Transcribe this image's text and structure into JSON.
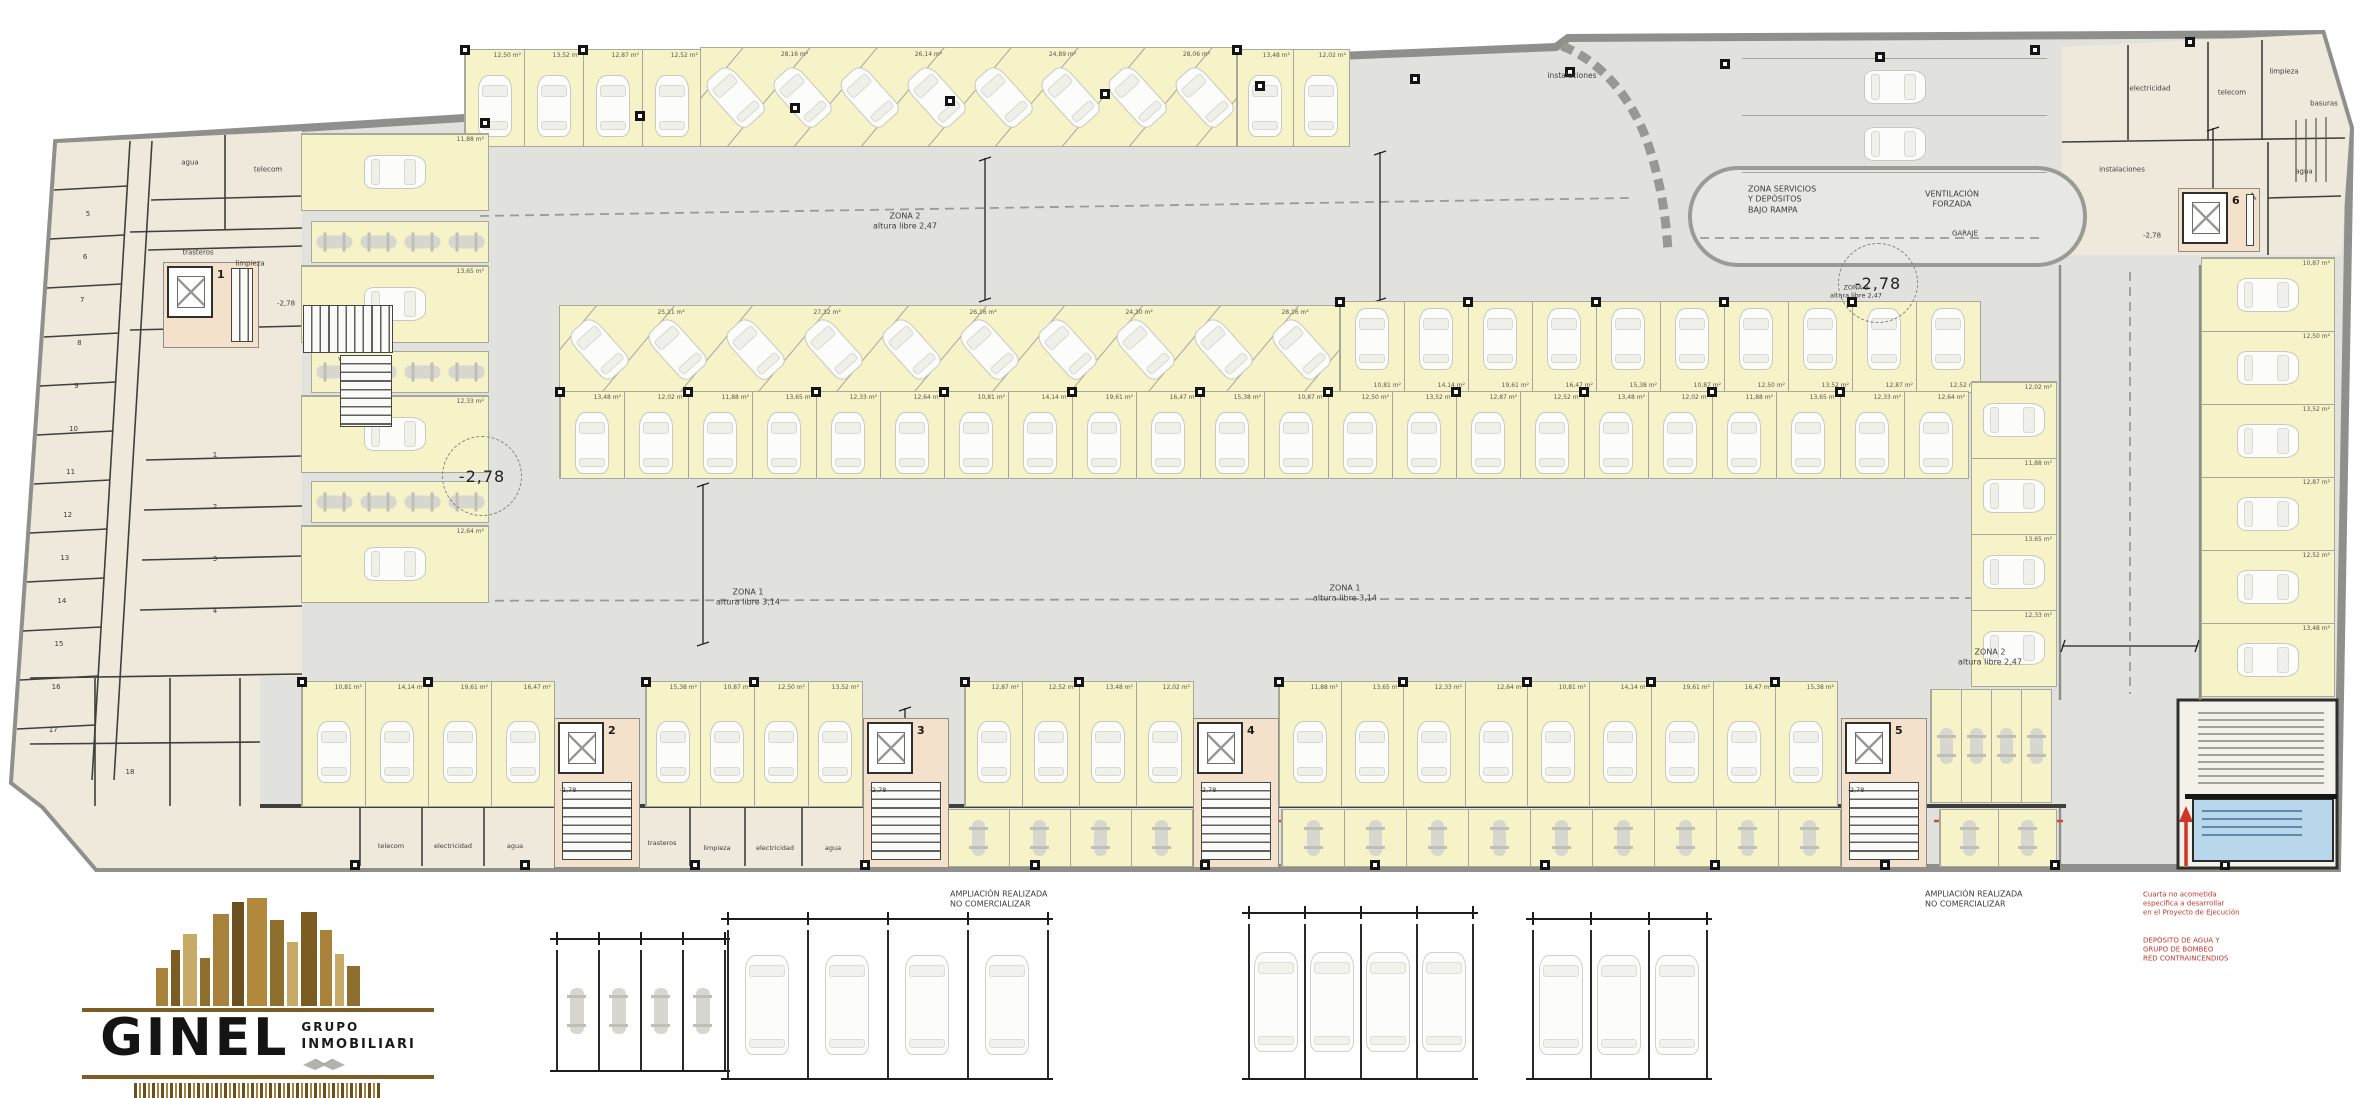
{
  "logo": {
    "name": "GINEL",
    "group_top": "GRUPO",
    "group_bottom": "INMOBILIARI"
  },
  "circles": [
    {
      "text": "-2,78",
      "x": 482,
      "y": 476
    },
    {
      "text": "-2,78",
      "x": 1878,
      "y": 283
    }
  ],
  "labels": [
    {
      "t": "ZONA 2\naltura libre 2,47",
      "x": 905,
      "y": 222,
      "s": 8
    },
    {
      "t": "ZONA 1\naltura libre 3,14",
      "x": 748,
      "y": 598,
      "s": 8
    },
    {
      "t": "ZONA 1\naltura libre 3,14",
      "x": 1345,
      "y": 594,
      "s": 8
    },
    {
      "t": "ZONA 2\naltura libre 2,47",
      "x": 1990,
      "y": 658,
      "s": 8
    },
    {
      "t": "ZONA 2\naltura libre 2,47",
      "x": 1856,
      "y": 292,
      "s": 6.5
    },
    {
      "t": "ZONA SERVICIOS\nY DEPÓSITOS\nBAJO RAMPA",
      "x": 1748,
      "y": 200,
      "s": 8,
      "a": "left"
    },
    {
      "t": "VENTILACIÓN\nFORZADA",
      "x": 1952,
      "y": 200,
      "s": 8
    },
    {
      "t": "GARAJE",
      "x": 1965,
      "y": 234,
      "s": 7
    },
    {
      "t": "instalaciones",
      "x": 1572,
      "y": 76,
      "s": 7.5
    },
    {
      "t": "VENTILACIÓN\nFORZADA",
      "x": 360,
      "y": 364,
      "s": 6.5
    },
    {
      "t": "agua",
      "x": 190,
      "y": 163,
      "s": 7
    },
    {
      "t": "telecom",
      "x": 268,
      "y": 170,
      "s": 7
    },
    {
      "t": "trasteros",
      "x": 198,
      "y": 253,
      "s": 7
    },
    {
      "t": "limpieza",
      "x": 250,
      "y": 264,
      "s": 7
    },
    {
      "t": "-2,78",
      "x": 286,
      "y": 304,
      "s": 7
    },
    {
      "t": "electricidad",
      "x": 2150,
      "y": 89,
      "s": 7
    },
    {
      "t": "telecom",
      "x": 2232,
      "y": 93,
      "s": 7
    },
    {
      "t": "limpieza",
      "x": 2284,
      "y": 72,
      "s": 7
    },
    {
      "t": "basuras",
      "x": 2324,
      "y": 104,
      "s": 7
    },
    {
      "t": "instalaciones",
      "x": 2122,
      "y": 170,
      "s": 7
    },
    {
      "t": "agua",
      "x": 2304,
      "y": 172,
      "s": 7
    },
    {
      "t": "-2,78",
      "x": 2152,
      "y": 236,
      "s": 7
    },
    {
      "t": "telecom",
      "x": 391,
      "y": 846,
      "s": 6.5
    },
    {
      "t": "electricidad",
      "x": 453,
      "y": 846,
      "s": 6.5
    },
    {
      "t": "agua",
      "x": 515,
      "y": 846,
      "s": 6.5
    },
    {
      "t": "trasteros",
      "x": 662,
      "y": 843,
      "s": 6.5
    },
    {
      "t": "limpieza",
      "x": 717,
      "y": 848,
      "s": 6.5
    },
    {
      "t": "electricidad",
      "x": 775,
      "y": 848,
      "s": 6.5
    },
    {
      "t": "agua",
      "x": 833,
      "y": 848,
      "s": 6.5
    },
    {
      "t": "-2,78",
      "x": 568,
      "y": 790,
      "s": 6.5
    },
    {
      "t": "-2,78",
      "x": 878,
      "y": 790,
      "s": 6.5
    },
    {
      "t": "-2,78",
      "x": 1208,
      "y": 790,
      "s": 6.5
    },
    {
      "t": "-2,78",
      "x": 1856,
      "y": 790,
      "s": 6.5
    },
    {
      "t": "AMPLIACIÓN REALIZADA\nNO COMERCIALIZAR",
      "x": 950,
      "y": 900,
      "s": 8,
      "a": "left"
    },
    {
      "t": "AMPLIACIÓN REALIZADA\nNO COMERCIALIZAR",
      "x": 1925,
      "y": 900,
      "s": 8,
      "a": "left"
    },
    {
      "t": "Cuarta no acometida\nespecífica a desarrollar\nen el Proyecto de Ejecución",
      "x": 2143,
      "y": 904,
      "s": 7,
      "c": "#c4352b",
      "a": "left"
    },
    {
      "t": "DEPÓSITO DE AGUA Y\nGRUPO DE BOMBEO\nRED CONTRAINCENDIOS",
      "x": 2143,
      "y": 950,
      "s": 7,
      "c": "#c4352b",
      "a": "left"
    }
  ],
  "left_wing": {
    "numbers": [
      "1",
      "2",
      "3",
      "4",
      "5",
      "6",
      "7",
      "8",
      "9",
      "10",
      "11",
      "12",
      "13",
      "14",
      "15",
      "16",
      "17",
      "18"
    ]
  },
  "cores": [
    {
      "num": "1",
      "x": 163,
      "y": 262,
      "w": 96,
      "h": 86,
      "layout": "right"
    },
    {
      "num": "2",
      "x": 554,
      "y": 718,
      "w": 86,
      "h": 150,
      "layout": "down"
    },
    {
      "num": "3",
      "x": 863,
      "y": 718,
      "w": 86,
      "h": 150,
      "layout": "down"
    },
    {
      "num": "4",
      "x": 1193,
      "y": 718,
      "w": 86,
      "h": 150,
      "layout": "down"
    },
    {
      "num": "5",
      "x": 1841,
      "y": 718,
      "w": 86,
      "h": 150,
      "layout": "down"
    },
    {
      "num": "6",
      "x": 2178,
      "y": 188,
      "w": 82,
      "h": 64,
      "layout": "right",
      "wheelchair": "♿"
    }
  ],
  "parking": {
    "area_labels": [
      "12,50 m²",
      "13,52 m²",
      "12,87 m²",
      "12,52 m²",
      "13,48 m²",
      "12,02 m²",
      "11,88 m²",
      "13,65 m²",
      "12,33 m²",
      "12,64 m²",
      "10,81 m²",
      "14,14 m²",
      "19,61 m²",
      "16,47 m²",
      "15,38 m²",
      "10,87 m²"
    ],
    "diag_labels": [
      "28,16 m²",
      "26,14 m²",
      "24,89 m²",
      "28,06 m²",
      "25,11 m²",
      "27,32 m²",
      "26,16 m²",
      "24,30 m²"
    ],
    "rows": [
      {
        "type": "v",
        "x": 465,
        "y": 50,
        "h": 96,
        "sw": 59,
        "n": 4,
        "dir": "down",
        "bg": true,
        "labels": true
      },
      {
        "type": "d",
        "x": 701,
        "y": 48,
        "h": 98,
        "sw": 67,
        "n": 8,
        "bg": true,
        "labels": true
      },
      {
        "type": "v",
        "x": 1237,
        "y": 50,
        "h": 96,
        "sw": 56,
        "n": 2,
        "dir": "down",
        "bg": true,
        "labels": true
      },
      {
        "type": "hs",
        "x": 1742,
        "y": 58,
        "w": 305,
        "sh": 57,
        "n": 2,
        "bg": false,
        "labels": false
      },
      {
        "type": "hs",
        "x": 302,
        "y": 134,
        "w": 186,
        "sh": 76,
        "n": 1,
        "bg": true,
        "labels": true
      },
      {
        "type": "motoH",
        "x": 312,
        "y": 222,
        "n": 4,
        "sw": 44,
        "h": 40,
        "bg": true
      },
      {
        "type": "hs",
        "x": 302,
        "y": 266,
        "w": 186,
        "sh": 76,
        "n": 1,
        "bg": true,
        "labels": true
      },
      {
        "type": "motoH",
        "x": 312,
        "y": 352,
        "n": 4,
        "sw": 44,
        "h": 40,
        "bg": true
      },
      {
        "type": "hs",
        "x": 302,
        "y": 396,
        "w": 186,
        "sh": 76,
        "n": 1,
        "bg": true,
        "labels": true
      },
      {
        "type": "motoH",
        "x": 312,
        "y": 482,
        "n": 4,
        "sw": 44,
        "h": 40,
        "bg": true
      },
      {
        "type": "hs",
        "x": 302,
        "y": 526,
        "w": 186,
        "sh": 76,
        "n": 1,
        "bg": true,
        "labels": true
      },
      {
        "type": "d",
        "x": 560,
        "y": 306,
        "h": 86,
        "sw": 78,
        "n": 10,
        "bg": true,
        "labels": true
      },
      {
        "type": "v",
        "x": 1340,
        "y": 302,
        "h": 90,
        "sw": 64,
        "n": 10,
        "dir": "up",
        "bg": true,
        "labels": true
      },
      {
        "type": "v",
        "x": 560,
        "y": 392,
        "h": 86,
        "sw": 64,
        "n": 22,
        "dir": "down",
        "bg": true,
        "labels": true
      },
      {
        "type": "v",
        "x": 302,
        "y": 682,
        "h": 124,
        "sw": 63,
        "n": 4,
        "dir": "down",
        "bg": true,
        "labels": true
      },
      {
        "type": "v",
        "x": 646,
        "y": 682,
        "h": 124,
        "sw": 54,
        "n": 4,
        "dir": "down",
        "bg": true,
        "labels": true
      },
      {
        "type": "v",
        "x": 965,
        "y": 682,
        "h": 124,
        "sw": 57,
        "n": 4,
        "dir": "down",
        "bg": true,
        "labels": true
      },
      {
        "type": "v",
        "x": 1279,
        "y": 682,
        "h": 124,
        "sw": 62,
        "n": 9,
        "dir": "down",
        "bg": true,
        "labels": true
      },
      {
        "type": "moto",
        "x": 1931,
        "y": 690,
        "h": 112,
        "sw": 30,
        "n": 4,
        "bg": true
      },
      {
        "type": "hs",
        "x": 2202,
        "y": 258,
        "w": 132,
        "sh": 73,
        "n": 6,
        "bg": true,
        "labels": true
      },
      {
        "type": "hs",
        "x": 1972,
        "y": 382,
        "w": 84,
        "sh": 76,
        "n": 4,
        "bg": true,
        "labels": true
      },
      {
        "type": "moto",
        "x": 948,
        "y": 810,
        "h": 56,
        "sw": 61,
        "n": 4,
        "bg": true
      },
      {
        "type": "moto",
        "x": 1282,
        "y": 810,
        "h": 56,
        "sw": 62,
        "n": 9,
        "bg": true
      },
      {
        "type": "moto",
        "x": 1940,
        "y": 810,
        "h": 56,
        "sw": 58,
        "n": 2,
        "bg": true
      }
    ]
  },
  "details": {
    "groups": [
      {
        "type": "moto",
        "x": 556,
        "y": 950,
        "n": 4,
        "sw": 42,
        "h": 122
      },
      {
        "type": "car",
        "x": 727,
        "y": 930,
        "n": 4,
        "sw": 80,
        "h": 150
      },
      {
        "type": "car",
        "x": 1248,
        "y": 924,
        "n": 4,
        "sw": 56,
        "h": 156
      },
      {
        "type": "car",
        "x": 1532,
        "y": 930,
        "n": 3,
        "sw": 58,
        "h": 150
      }
    ]
  }
}
